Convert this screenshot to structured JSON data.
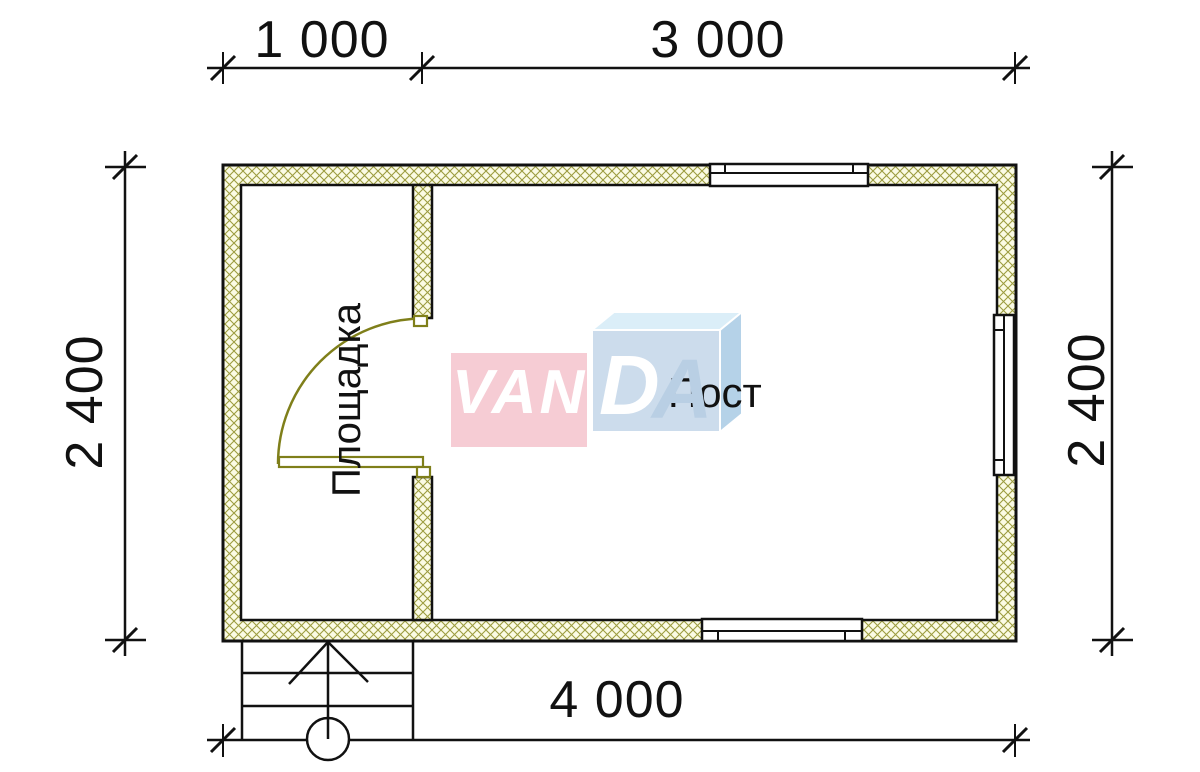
{
  "theme": {
    "line": "#111111",
    "text": "#111111",
    "hatch_line": "#9c9c3f",
    "hatch_bg": "#fbfbe4",
    "door": "#7f7f1a",
    "wm_pink": "#f6ccd4",
    "wm_pale_blue_top": "#dbeef8",
    "wm_blue_front": "#ccdcec",
    "wm_blue_side": "#b5d2e8",
    "wm_letter_white": "#ffffff",
    "wm_letter_blue": "#b9cfe4"
  },
  "dimensions": {
    "top_segment_1": "1 000",
    "top_segment_2": "3 000",
    "left_side": "2 400",
    "right_side": "2 400",
    "bottom_total": "4 000"
  },
  "rooms": {
    "entry_platform": "Площадка",
    "main_room": "Пост"
  },
  "watermark": {
    "letters_front": "VAN",
    "letter_d": "D",
    "letter_a": "A"
  }
}
